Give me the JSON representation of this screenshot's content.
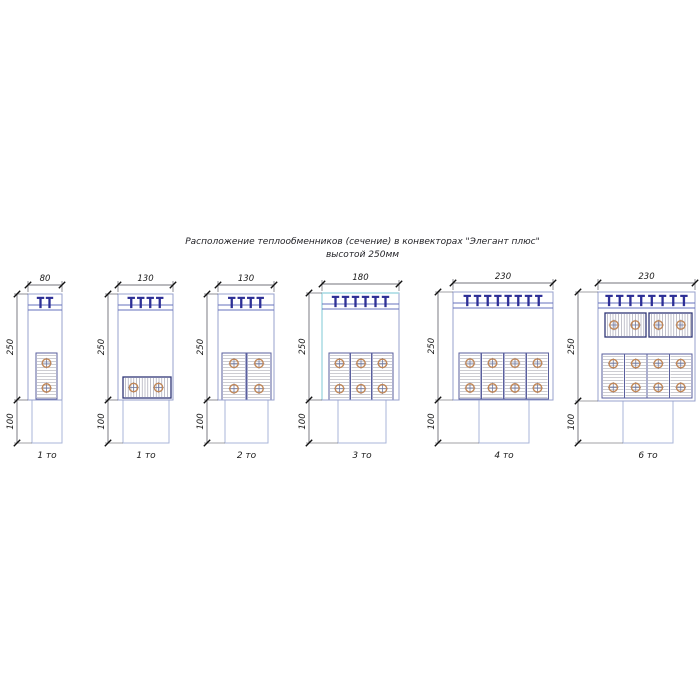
{
  "title": {
    "line1": "Расположение теплообменников (сечение) в конвекторах \"Элегант плюс\"",
    "line2": "высотой 250мм"
  },
  "colors": {
    "background": "#ffffff",
    "body_stroke": "#97a1cd",
    "duct_stroke": "#a9b6d9",
    "grille_line": "#6670bd",
    "slat": "#2d2f96",
    "vpanel_border": "#5a5f9e",
    "vpanel_hatch": "#9c9ca6",
    "hpanel_border": "#2f3576",
    "hpanel_hatch": "#9898a8",
    "tube_ring": "#c08758",
    "tube_cross": "#7079a0",
    "dim_line": "#44444f",
    "dim_tick": "#111111",
    "dim_text": "#1a1a1a",
    "cyan_edge": "#a4d8e2"
  },
  "diagrams": [
    {
      "label": "1 то",
      "width_label": "80",
      "height_label": "250",
      "duct_label": "100",
      "dim_x": 17,
      "cyan": false,
      "body": {
        "x": 28,
        "y": 294,
        "w": 34,
        "h": 106
      },
      "duct": {
        "x": 32,
        "w": 30,
        "h": 43
      },
      "slats": {
        "count": 2,
        "spacing": 9
      },
      "exchangers": [
        {
          "type": "v",
          "x": 36,
          "y": 353,
          "w": 21,
          "h": 46
        }
      ]
    },
    {
      "label": "1 то",
      "width_label": "130",
      "height_label": "250",
      "duct_label": "100",
      "dim_x": 108,
      "cyan": false,
      "body": {
        "x": 118,
        "y": 294,
        "w": 55,
        "h": 106
      },
      "duct": {
        "x": 123,
        "w": 46,
        "h": 43
      },
      "slats": {
        "count": 4,
        "spacing": 9.5
      },
      "exchangers": [
        {
          "type": "h",
          "x": 123,
          "y": 377,
          "w": 48,
          "h": 21
        }
      ]
    },
    {
      "label": "2 то",
      "width_label": "130",
      "height_label": "250",
      "duct_label": "100",
      "dim_x": 207,
      "cyan": false,
      "body": {
        "x": 218,
        "y": 294,
        "w": 56,
        "h": 106
      },
      "duct": {
        "x": 225,
        "w": 43,
        "h": 43
      },
      "slats": {
        "count": 4,
        "spacing": 9.5
      },
      "exchangers": [
        {
          "type": "v",
          "x": 222,
          "y": 353,
          "w": 24,
          "h": 47
        },
        {
          "type": "v",
          "x": 247,
          "y": 353,
          "w": 24,
          "h": 47
        }
      ]
    },
    {
      "label": "3 то",
      "width_label": "180",
      "height_label": "250",
      "duct_label": "100",
      "dim_x": 309,
      "cyan": true,
      "body": {
        "x": 322,
        "y": 293,
        "w": 77,
        "h": 107
      },
      "duct": {
        "x": 338,
        "w": 48,
        "h": 43
      },
      "slats": {
        "count": 6,
        "spacing": 10
      },
      "exchangers": [
        {
          "type": "v",
          "x": 329,
          "y": 353,
          "w": 21,
          "h": 47
        },
        {
          "type": "v",
          "x": 350.5,
          "y": 353,
          "w": 21,
          "h": 47
        },
        {
          "type": "v",
          "x": 372,
          "y": 353,
          "w": 21,
          "h": 47
        }
      ]
    },
    {
      "label": "4 то",
      "width_label": "230",
      "height_label": "250",
      "duct_label": "100",
      "dim_x": 438,
      "cyan": false,
      "body": {
        "x": 453,
        "y": 292,
        "w": 100,
        "h": 108
      },
      "duct": {
        "x": 479,
        "w": 50,
        "h": 43
      },
      "slats": {
        "count": 8,
        "spacing": 10.2
      },
      "exchangers": [
        {
          "type": "v",
          "x": 459,
          "y": 353,
          "w": 22,
          "h": 46
        },
        {
          "type": "v",
          "x": 481.5,
          "y": 353,
          "w": 22,
          "h": 46
        },
        {
          "type": "v",
          "x": 504,
          "y": 353,
          "w": 22,
          "h": 46
        },
        {
          "type": "v",
          "x": 526.5,
          "y": 353,
          "w": 22,
          "h": 46
        }
      ]
    },
    {
      "label": "6 то",
      "width_label": "230",
      "height_label": "250",
      "duct_label": "100",
      "dim_x": 578,
      "cyan": false,
      "body": {
        "x": 598,
        "y": 292,
        "w": 97,
        "h": 109
      },
      "duct": {
        "x": 623,
        "w": 50,
        "h": 42
      },
      "slats": {
        "count": 8,
        "spacing": 10.7
      },
      "exchangers": [
        {
          "type": "h",
          "x": 605,
          "y": 313,
          "w": 41,
          "h": 24
        },
        {
          "type": "h",
          "x": 649,
          "y": 313,
          "w": 43,
          "h": 24
        },
        {
          "type": "v",
          "x": 602,
          "y": 354,
          "w": 22.5,
          "h": 44
        },
        {
          "type": "v",
          "x": 624.5,
          "y": 354,
          "w": 22.5,
          "h": 44
        },
        {
          "type": "v",
          "x": 647,
          "y": 354,
          "w": 22.5,
          "h": 44
        },
        {
          "type": "v",
          "x": 669.5,
          "y": 354,
          "w": 22.5,
          "h": 44
        }
      ]
    }
  ]
}
